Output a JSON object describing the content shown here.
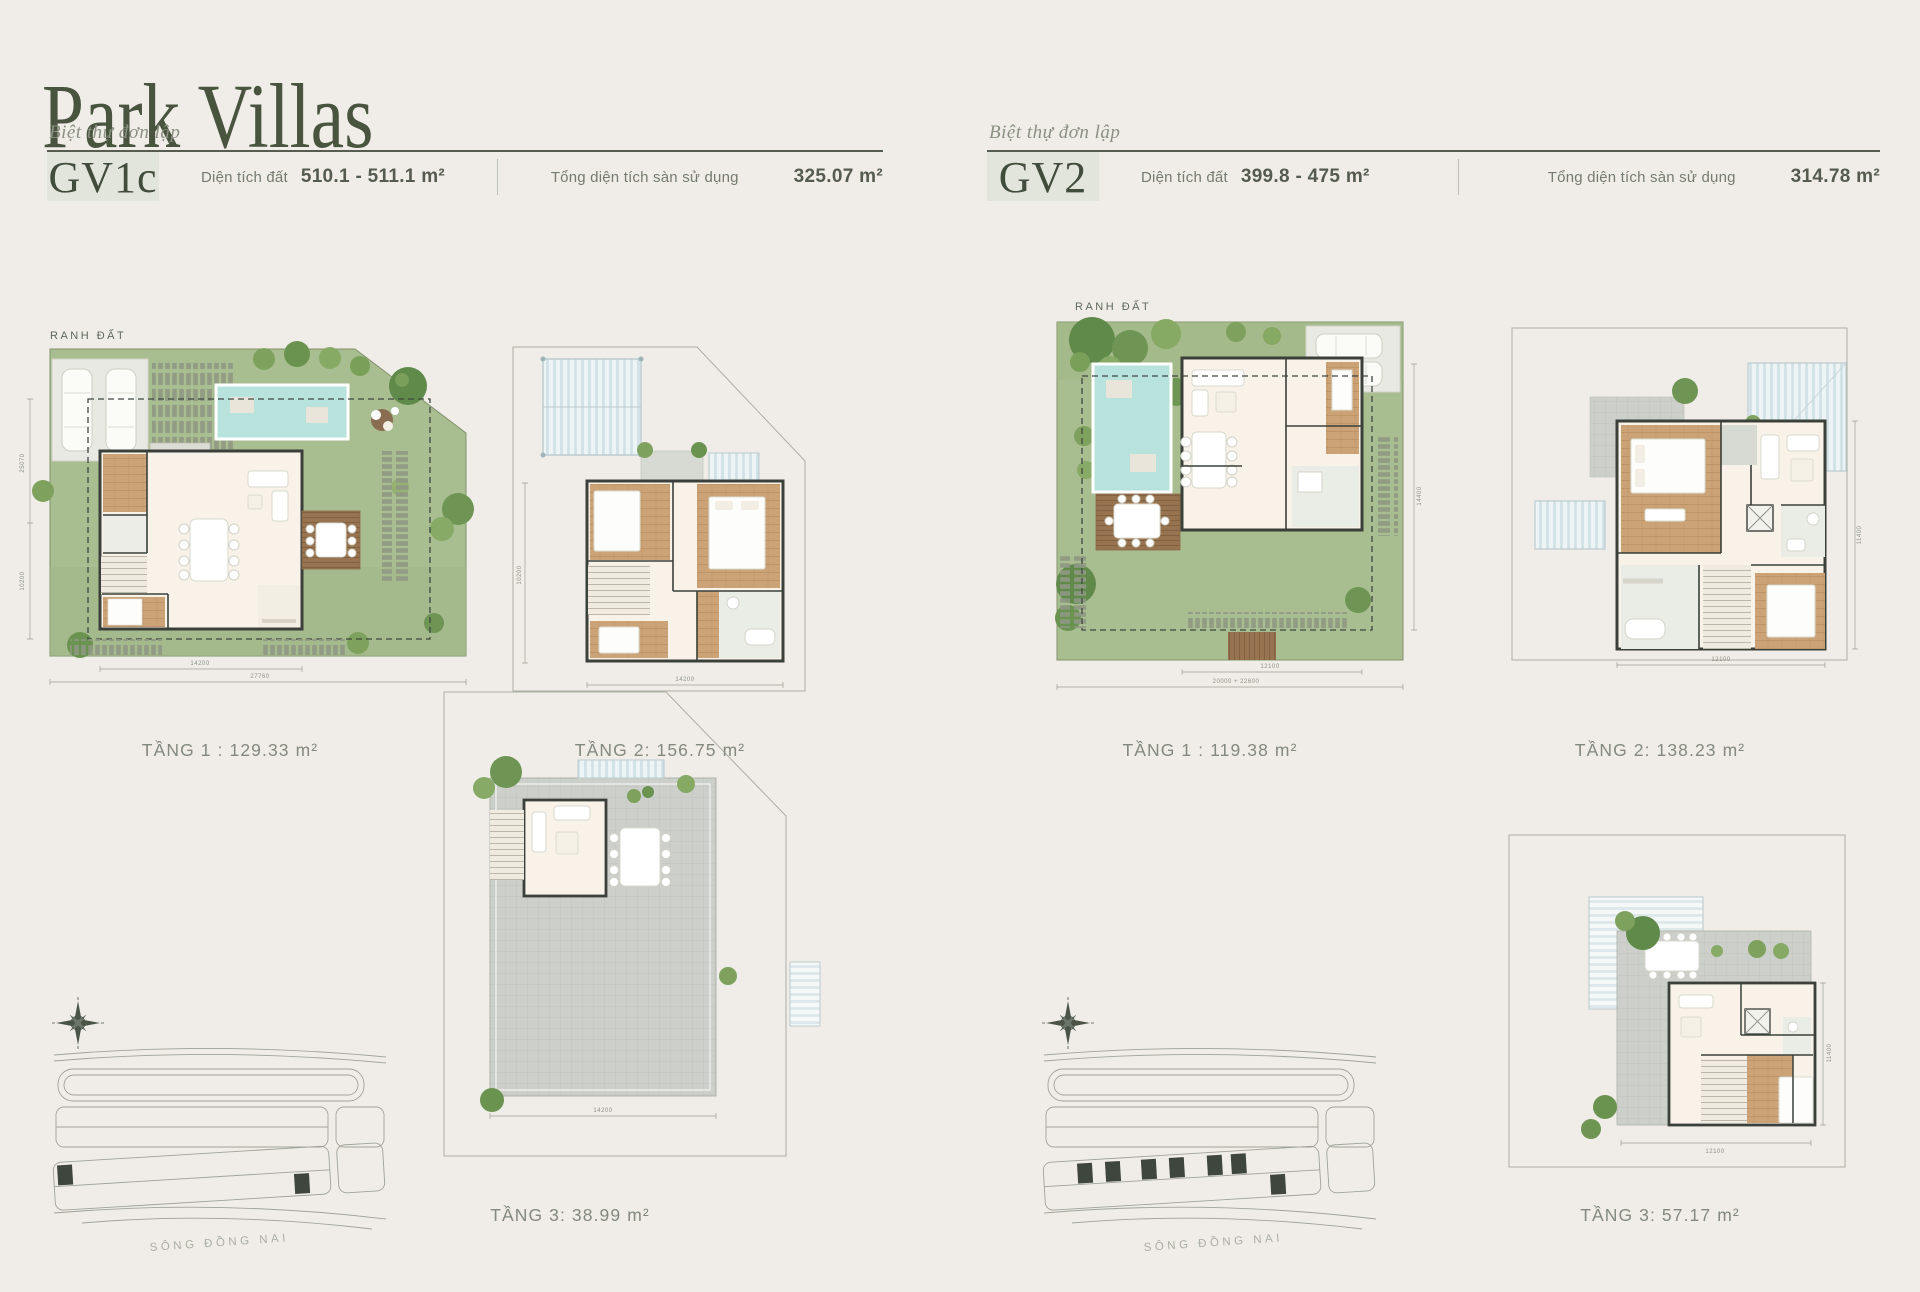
{
  "page": {
    "title": "Park Villas"
  },
  "colors": {
    "background": "#F0EDE8",
    "accent_green": "#49543F",
    "badge_bg": "#E2E5DB",
    "caption_gray": "#83897E",
    "lawn": "#A9BE90",
    "pool": "#B7E3DC",
    "wood_floor": "#CBA377",
    "deck_wood": "#97744F",
    "terrace_tile": "#CDD0CA",
    "wall": "#3B403B",
    "map_line": "#9FA399",
    "highlight_plot": "#3E463E"
  },
  "villas": [
    {
      "code": "GV1c",
      "type_label": "Biệt thự đơn lập",
      "land_label": "Diện tích đất",
      "land_value": "510.1 - 511.1 m²",
      "floor_label": "Tổng diện tích sàn sử dụng",
      "floor_value": "325.07 m²",
      "boundary_label": "RANH ĐẤT",
      "river_label": "SÔNG ĐỒNG NAI",
      "captions": {
        "t1": "TẦNG 1 : 129.33 m²",
        "t2": "TẦNG 2: 156.75 m²",
        "t3": "TẦNG 3: 38.99 m²"
      },
      "dims": {
        "site_w1": "14200",
        "site_w2": "27760",
        "site_h1": "25070",
        "site_h2": "10200",
        "t2_w": "14200",
        "t2_h": "10200",
        "t3_w": "14200"
      }
    },
    {
      "code": "GV2",
      "type_label": "Biệt thự đơn lập",
      "land_label": "Diện tích đất",
      "land_value": "399.8 - 475 m²",
      "floor_label": "Tổng diện tích sàn sử dụng",
      "floor_value": "314.78 m²",
      "boundary_label": "RANH ĐẤT",
      "river_label": "SÔNG ĐỒNG NAI",
      "captions": {
        "t1": "TẦNG 1 : 119.38 m²",
        "t2": "TẦNG 2: 138.23 m²",
        "t3": "TẦNG 3: 57.17 m²"
      },
      "dims": {
        "site_w1": "12100",
        "site_w2": "20000 + 22600",
        "site_h1": "14400",
        "t2_w": "12100",
        "t2_h": "11400",
        "t3_w": "12100",
        "t3_h": "11400"
      }
    }
  ]
}
